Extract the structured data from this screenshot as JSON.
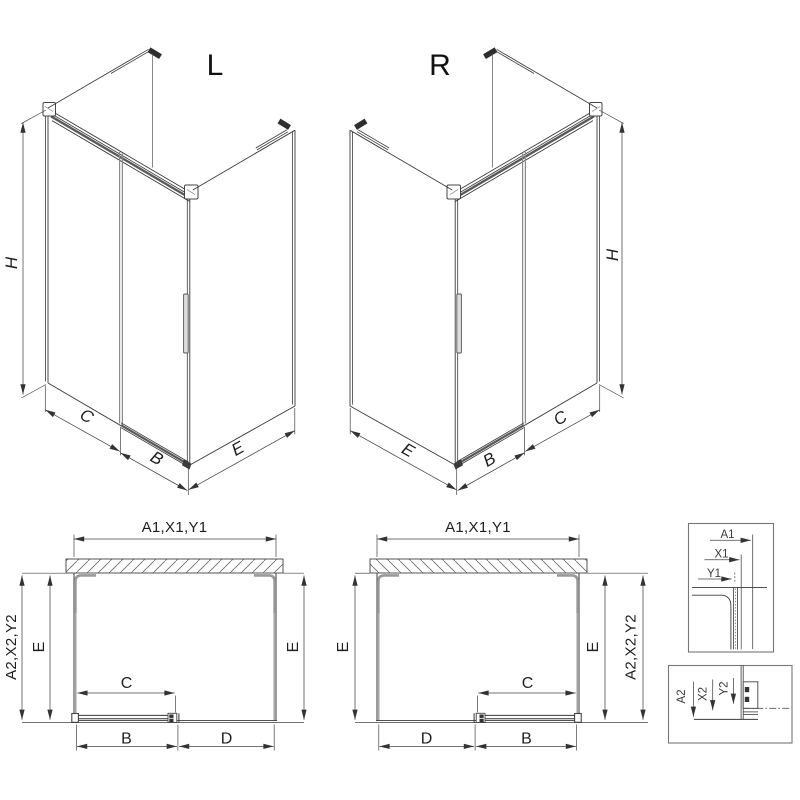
{
  "drawing": {
    "iso_left": {
      "title": "L",
      "height_dim": "H",
      "fixed_dim": "C",
      "door_dim": "B",
      "side_dim": "E"
    },
    "iso_right": {
      "title": "R",
      "height_dim": "H",
      "fixed_dim": "C",
      "door_dim": "B",
      "side_dim": "E"
    },
    "plan_left": {
      "top_dim": "A1,X1,Y1",
      "outer_dim": "A2,X2,Y2",
      "left_depth_dim": "E",
      "right_depth_dim": "E",
      "opening_dim": "C",
      "door_dim": "B",
      "fixed_dim": "D"
    },
    "plan_right": {
      "top_dim": "A1,X1,Y1",
      "outer_dim": "A2,X2,Y2",
      "left_depth_dim": "E",
      "right_depth_dim": "E",
      "opening_dim": "C",
      "door_dim": "B",
      "fixed_dim": "D"
    },
    "detail_top": {
      "dims": [
        "A1",
        "X1",
        "Y1"
      ]
    },
    "detail_bottom": {
      "dims": [
        "A2",
        "X2",
        "Y2"
      ]
    },
    "colors": {
      "line": "#3a3a3a",
      "dim": "#444444",
      "profile": "#9a9a9a",
      "dark_fill": "#333333",
      "background": "#ffffff"
    }
  }
}
